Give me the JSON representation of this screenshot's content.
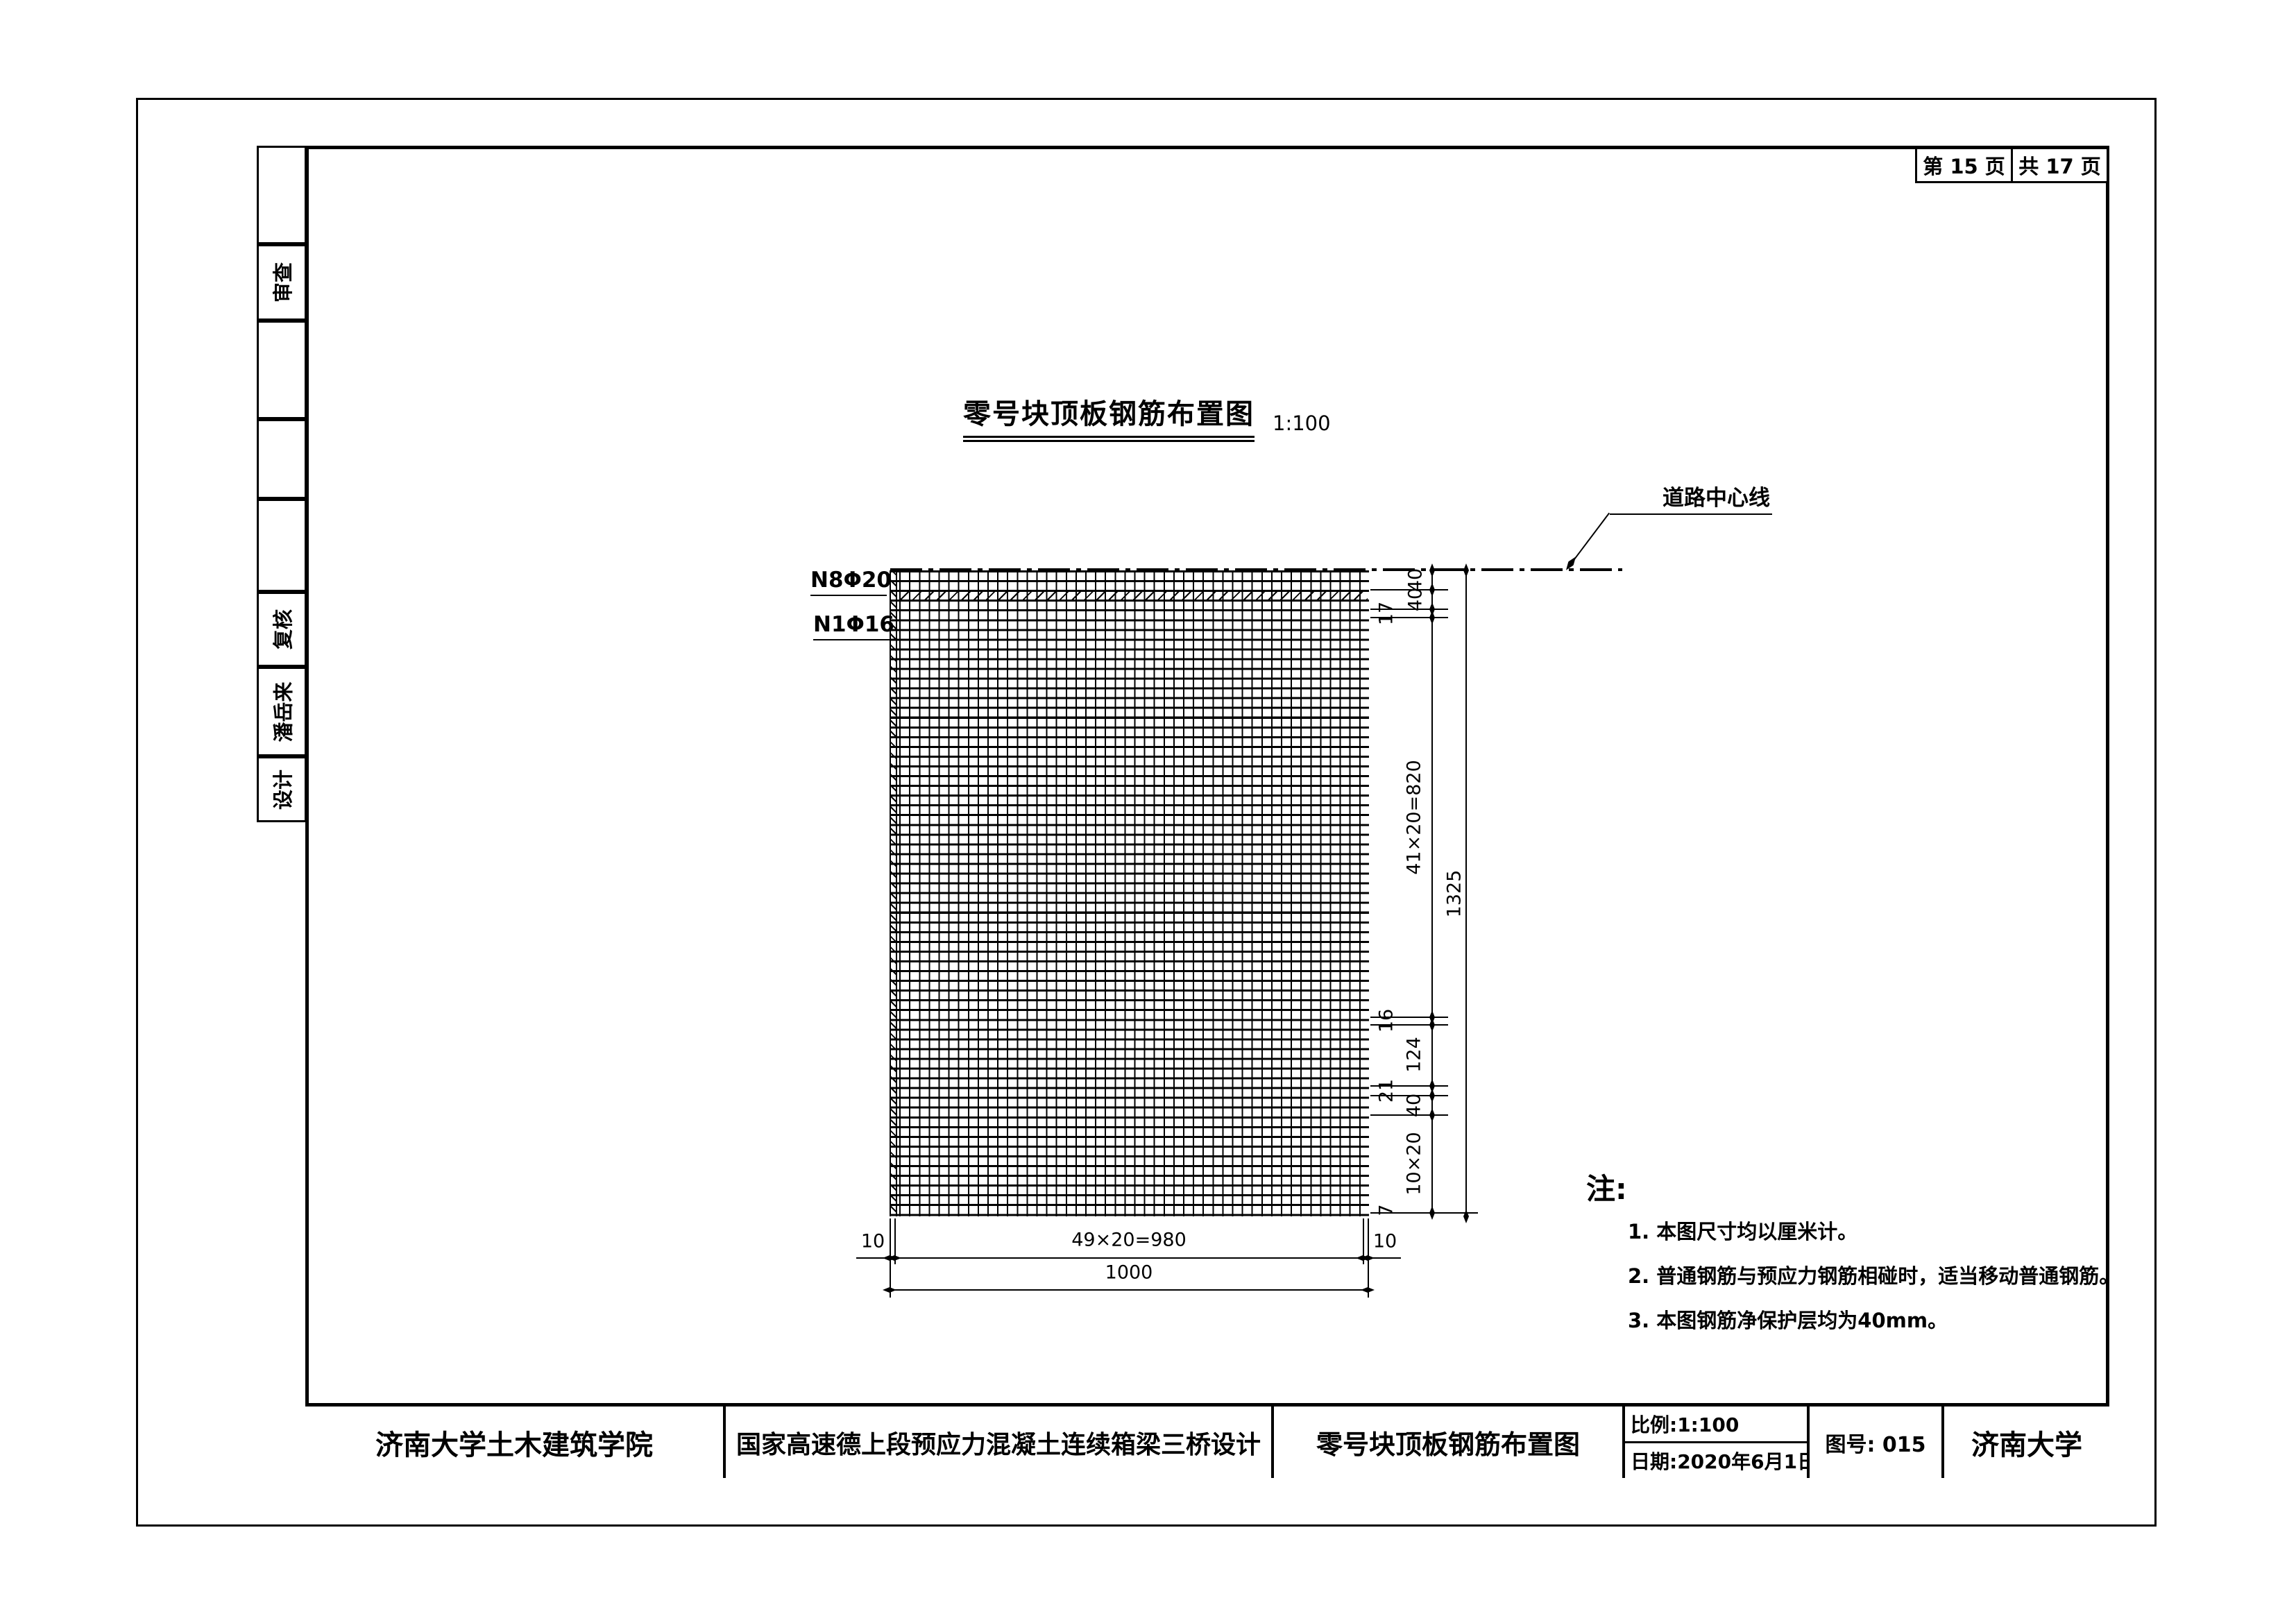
{
  "page": {
    "page_label": "第 15 页",
    "total_label": "共 17 页"
  },
  "sidebar": {
    "items": [
      {
        "label": ""
      },
      {
        "label": "审查"
      },
      {
        "label": ""
      },
      {
        "label": ""
      },
      {
        "label": ""
      },
      {
        "label": "复核"
      },
      {
        "label": "潘岳来"
      },
      {
        "label": "设计"
      }
    ]
  },
  "drawing": {
    "title": "零号块顶板钢筋布置图",
    "scale": "1:100",
    "centerline_label": "道路中心线",
    "rebar_labels": {
      "top": "N8Φ20",
      "second": "N1Φ16"
    },
    "dims": {
      "vertical_chain": [
        "40",
        "40",
        "17",
        "41×20=820",
        "16",
        "124",
        "21",
        "40",
        "10×20",
        "7"
      ],
      "vertical_overall": "1325",
      "h_left": "10",
      "h_mid": "49×20=980",
      "h_right": "10",
      "h_overall": "1000"
    }
  },
  "notes": {
    "heading": "注:",
    "items": [
      "1. 本图尺寸均以厘米计。",
      "2. 普通钢筋与预应力钢筋相碰时，适当移动普通钢筋。",
      "3. 本图钢筋净保护层均为40mm。"
    ]
  },
  "titleblock": {
    "college": "济南大学土木建筑学院",
    "project": "国家高速德上段预应力混凝土连续箱梁三桥设计",
    "sheet_title": "零号块顶板钢筋布置图",
    "scale_label": "比例:1:100",
    "date_label": "日期:2020年6月1日",
    "number_label": "图号: 015",
    "university": "济南大学"
  },
  "colors": {
    "ink": "#000000",
    "paper": "#ffffff"
  }
}
